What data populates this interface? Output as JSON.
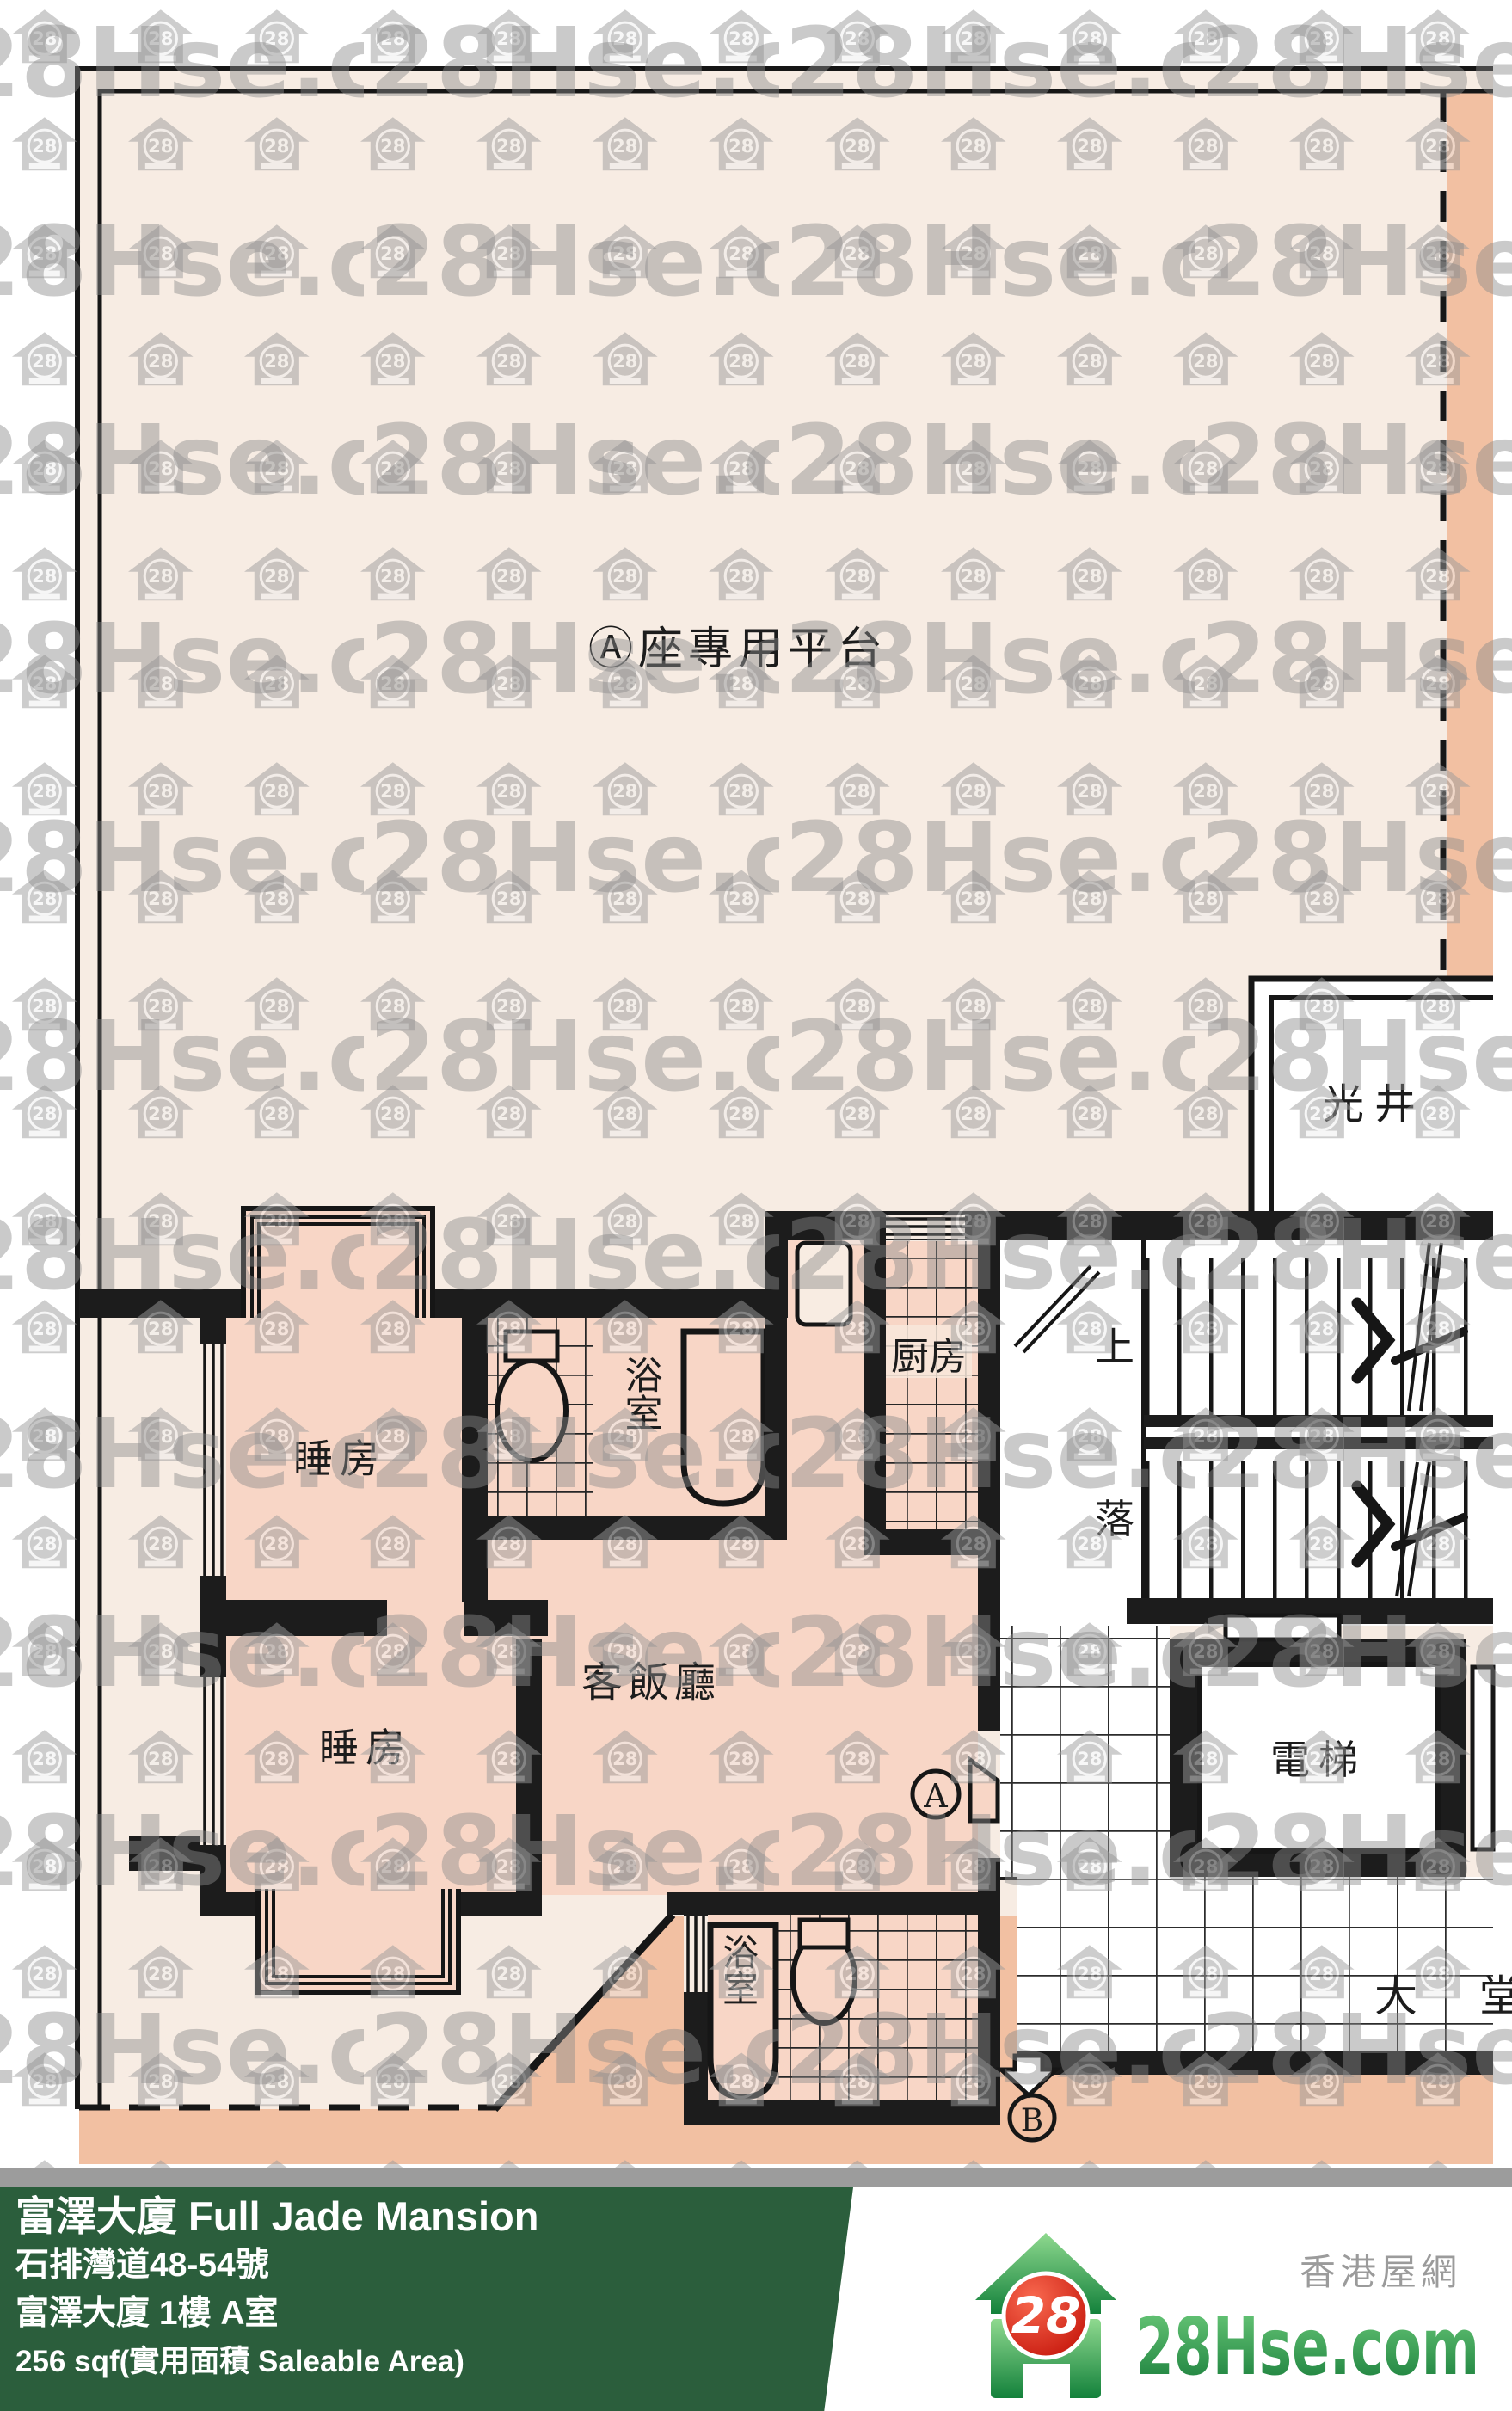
{
  "plan": {
    "terrace": "Ⓐ座專用平台",
    "light_well": "光井",
    "bedroom1": "睡房",
    "bedroom2": "睡房",
    "bathroom1": "浴室",
    "bathroom2": "浴室",
    "kitchen": "厨房",
    "living": "客飯廳",
    "stairs_up": "上",
    "stairs_down": "落",
    "elevator": "電梯",
    "lobby": "大堂",
    "marker_a": "A",
    "marker_b": "B"
  },
  "watermark": {
    "brand": "28Hse.com",
    "badge": "28"
  },
  "footer": {
    "title": "富澤大廈 Full Jade Mansion",
    "address": "石排灣道48-54號",
    "unit": "富澤大廈 1樓 A室",
    "area": "256 sqf(實用面積 Saleable Area)"
  },
  "logo": {
    "brand": "28Hse.com",
    "badge": "28",
    "tagline": "香港屋網"
  },
  "colors": {
    "terrace_cream": "#f7ece3",
    "room_pink": "#f8d6c6",
    "outside_salmon": "#f2c0a2",
    "wall_black": "#1c1c1c",
    "footer_green": "#2b5e3c",
    "logo_red": "#d register0d04"
  }
}
